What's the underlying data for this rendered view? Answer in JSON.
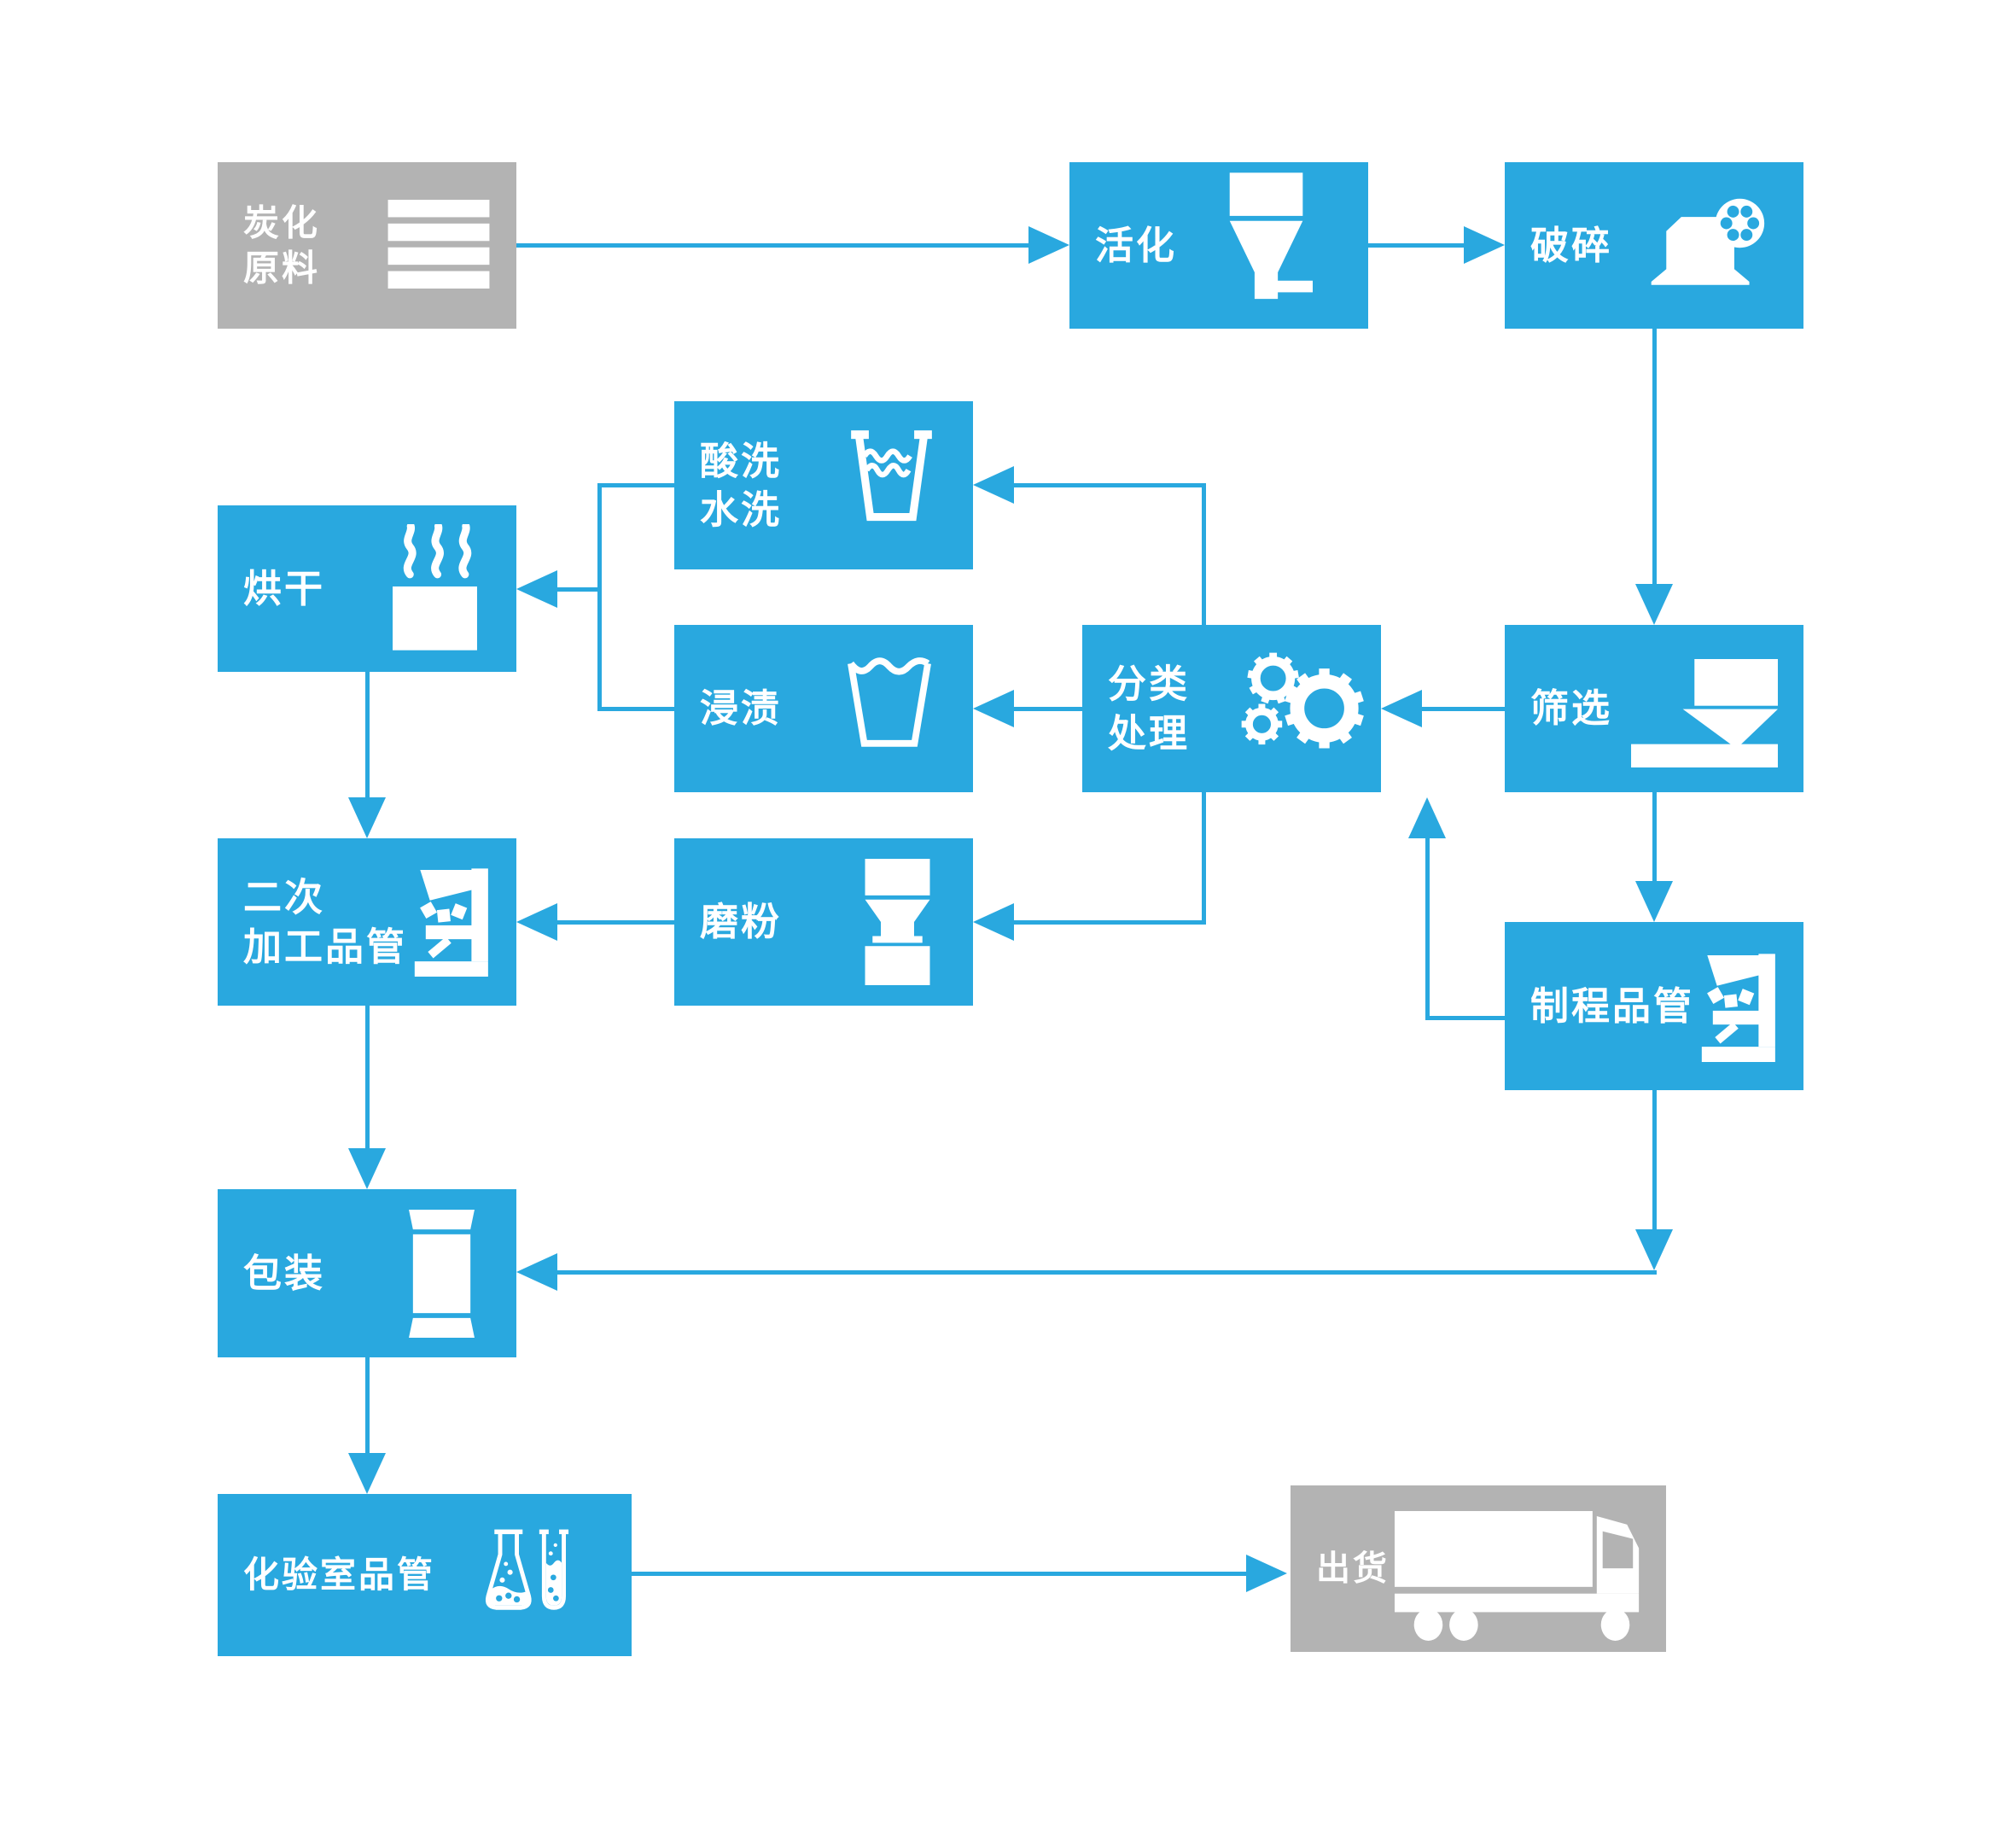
{
  "diagram": {
    "description": "Activated carbon production process flowchart",
    "colors": {
      "node_blue": "#29A8DF",
      "node_gray": "#B3B3B3",
      "arrow": "#29A8DF",
      "label_text": "#FFFFFF",
      "background": "#FFFFFF"
    },
    "nodes": {
      "carbonize": {
        "label_lines": [
          "炭化",
          "原料"
        ],
        "icon": "layers-icon",
        "style": "gray"
      },
      "activate": {
        "label": "活化",
        "icon": "funnel-icon",
        "style": "blue"
      },
      "crush": {
        "label": "破碎",
        "icon": "crusher-icon",
        "style": "blue"
      },
      "acid_wash": {
        "label_lines": [
          "酸洗",
          "水洗"
        ],
        "icon": "wash-cup-icon",
        "style": "blue"
      },
      "dry": {
        "label": "烘干",
        "icon": "steam-icon",
        "style": "blue"
      },
      "impregnate": {
        "label": "浸渍",
        "icon": "soak-cup-icon",
        "style": "blue"
      },
      "classify": {
        "label_lines": [
          "分类",
          "处理"
        ],
        "icon": "gears-icon",
        "style": "blue"
      },
      "sieve": {
        "label": "筛选",
        "icon": "sieve-icon",
        "style": "blue"
      },
      "secondary_qc": {
        "label_lines": [
          "二次",
          "加工品管"
        ],
        "icon": "microscope-icon",
        "style": "blue"
      },
      "grind": {
        "label": "磨粉",
        "icon": "mill-icon",
        "style": "blue"
      },
      "process_qc": {
        "label": "制程品管",
        "icon": "microscope-icon",
        "style": "blue"
      },
      "pack": {
        "label": "包装",
        "icon": "package-icon",
        "style": "blue"
      },
      "lab_qc": {
        "label": "化验室品管",
        "icon": "flask-tube-icon",
        "style": "blue"
      },
      "ship": {
        "label": "出货",
        "icon": "truck-icon",
        "style": "gray"
      }
    },
    "edges": [
      {
        "from": "carbonize",
        "to": "activate"
      },
      {
        "from": "activate",
        "to": "crush"
      },
      {
        "from": "crush",
        "to": "sieve"
      },
      {
        "from": "sieve",
        "to": "classify"
      },
      {
        "from": "classify",
        "to": "acid_wash"
      },
      {
        "from": "classify",
        "to": "impregnate"
      },
      {
        "from": "classify",
        "to": "grind"
      },
      {
        "from": "acid_wash",
        "to": "dry"
      },
      {
        "from": "impregnate",
        "to": "dry"
      },
      {
        "from": "dry",
        "to": "secondary_qc"
      },
      {
        "from": "grind",
        "to": "secondary_qc"
      },
      {
        "from": "secondary_qc",
        "to": "pack"
      },
      {
        "from": "sieve",
        "to": "process_qc"
      },
      {
        "from": "process_qc",
        "to": "classify"
      },
      {
        "from": "process_qc",
        "to": "pack"
      },
      {
        "from": "pack",
        "to": "lab_qc"
      },
      {
        "from": "lab_qc",
        "to": "ship"
      }
    ]
  }
}
